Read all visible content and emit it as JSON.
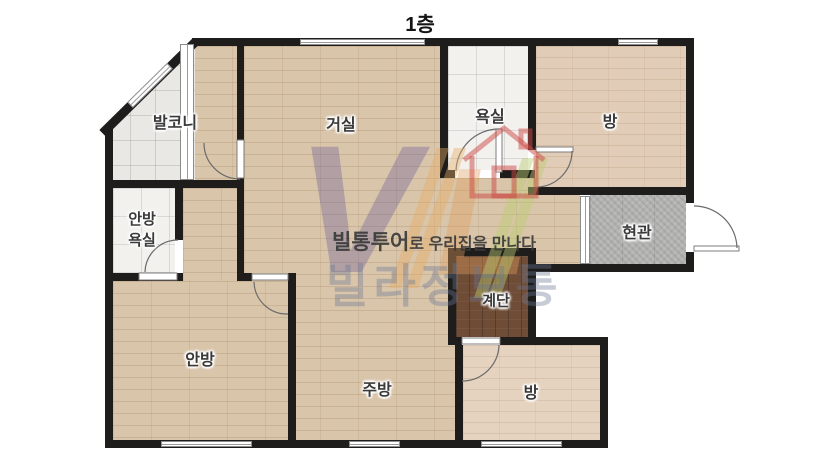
{
  "title": "1층",
  "rooms": [
    {
      "id": "balcony",
      "label": "발코니"
    },
    {
      "id": "living-room",
      "label": "거실"
    },
    {
      "id": "bathroom",
      "label": "욕실"
    },
    {
      "id": "room-top-right",
      "label": "방"
    },
    {
      "id": "master-bathroom",
      "label_line1": "안방",
      "label_line2": "욕실"
    },
    {
      "id": "entrance",
      "label": "현관"
    },
    {
      "id": "stairs",
      "label": "계단"
    },
    {
      "id": "master-bedroom",
      "label": "안방"
    },
    {
      "id": "kitchen",
      "label": "주방"
    },
    {
      "id": "room-bottom-right",
      "label": "방"
    }
  ],
  "watermark": {
    "logo_v": "V",
    "logo_l": "L",
    "tagline_bold": "빌통투어",
    "tagline_rest": "로 우리집을 만나다",
    "brand": "빌라정보통"
  },
  "colors": {
    "wall": "#1e1d1c",
    "wood_floor": "#d9c5aa",
    "light_wood_floor": "#e1cdb7",
    "balcony_tile": "#eae8e4",
    "bath_tile": "#f2f1ee",
    "entry_tile": "#b3b3b1",
    "stairs_floor": "#6e4c36",
    "logo_purple": "#6a5c98",
    "logo_orange": "#de9e5c",
    "brand_text": "#6c7694"
  }
}
